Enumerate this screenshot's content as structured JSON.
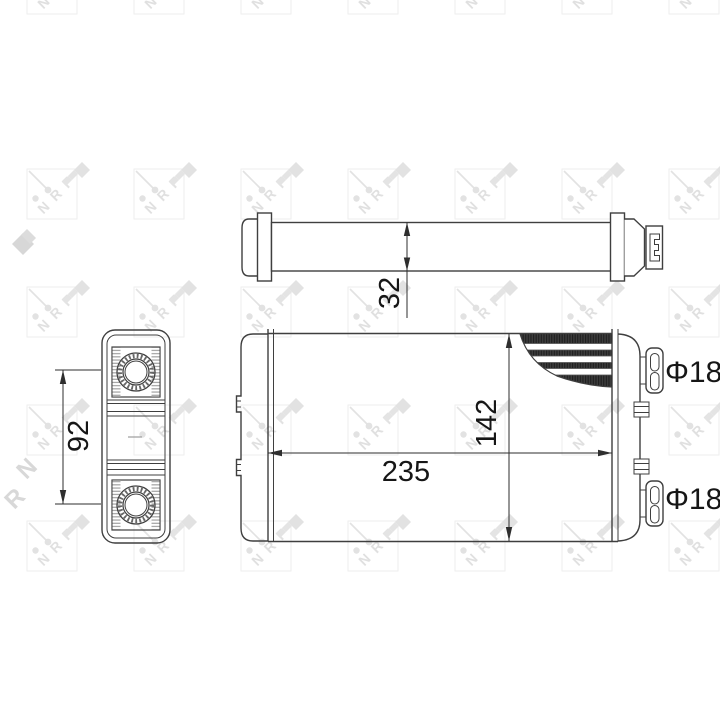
{
  "title": "heater-core-technical-drawing",
  "dimensions": {
    "top_view_depth": "32",
    "front_view_width": "235",
    "front_view_height": "142",
    "side_view_pipe_pitch": "92"
  },
  "labels": {
    "pipe_top_diameter": "Φ18",
    "pipe_bottom_diameter": "Φ18"
  },
  "watermark": {
    "letters": [
      "N",
      "R",
      "F"
    ]
  },
  "colors": {
    "line": "#3f3f3f",
    "dimension_line": "#2e2e2e",
    "text": "#161616",
    "fin_dark": "#3a3a3a",
    "watermark_light": "#e2e2e2",
    "watermark_dark": "#d7d7d7",
    "background": "#ffffff"
  }
}
